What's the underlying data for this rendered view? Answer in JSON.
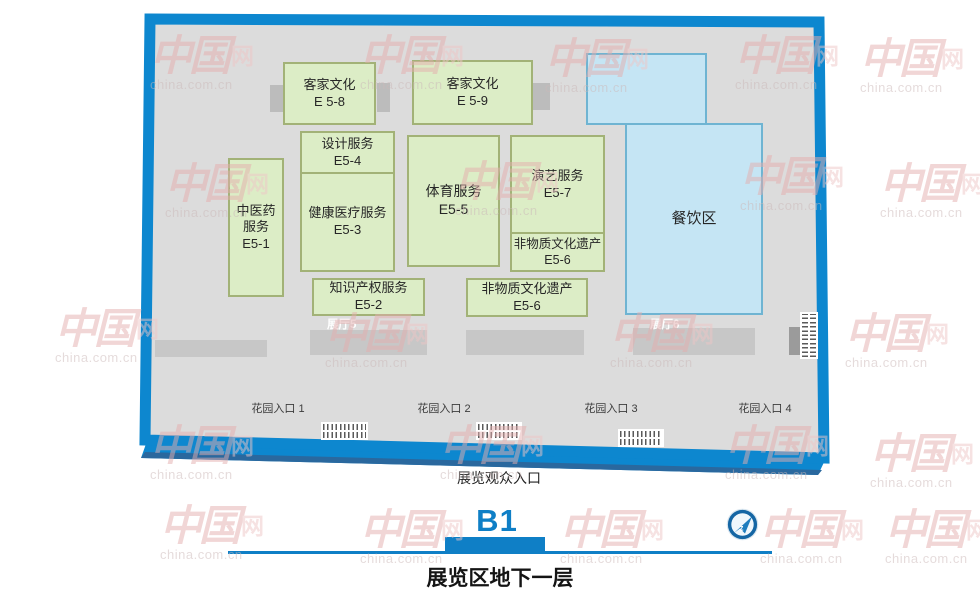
{
  "map": {
    "booths": [
      {
        "name": "客家文化",
        "code": "E 5-8"
      },
      {
        "name": "客家文化",
        "code": "E 5-9"
      },
      {
        "name": "中医药\n服务",
        "code": "E5-1"
      },
      {
        "name": "设计服务",
        "code": "E5-4"
      },
      {
        "name": "健康医疗服务",
        "code": "E5-3"
      },
      {
        "name": "体育服务",
        "code": "E5-5"
      },
      {
        "name": "演艺服务",
        "code": "E5-7"
      },
      {
        "name": "非物质文化遗产",
        "code": "E5-6"
      },
      {
        "name": "知识产权服务",
        "code": "E5-2"
      },
      {
        "name": "非物质文化遗产",
        "code": "E5-6"
      },
      {
        "name": "餐饮区",
        "code": ""
      }
    ],
    "hall_labels": [
      "展厅5",
      "展厅6"
    ],
    "garden_entrances": [
      "花园入口 1",
      "花园入口 2",
      "花园入口 3",
      "花园入口 4"
    ],
    "visitor_entrance": "展览观众入口"
  },
  "legend": {
    "floor_code": "B1",
    "floor_title": "展览区地下一层"
  },
  "watermark": {
    "logo": "中国",
    "net": "网",
    "url": "china.com.cn"
  },
  "colors": {
    "outline_blue": "#0d87cf",
    "floor_gray": "#dcdcdc",
    "booth_green": "#dcedc6",
    "booth_green_border": "#a2b277",
    "booth_blue": "#c5e5f4",
    "booth_blue_border": "#6fb4d2",
    "accent_blue": "#0f7fc6"
  }
}
